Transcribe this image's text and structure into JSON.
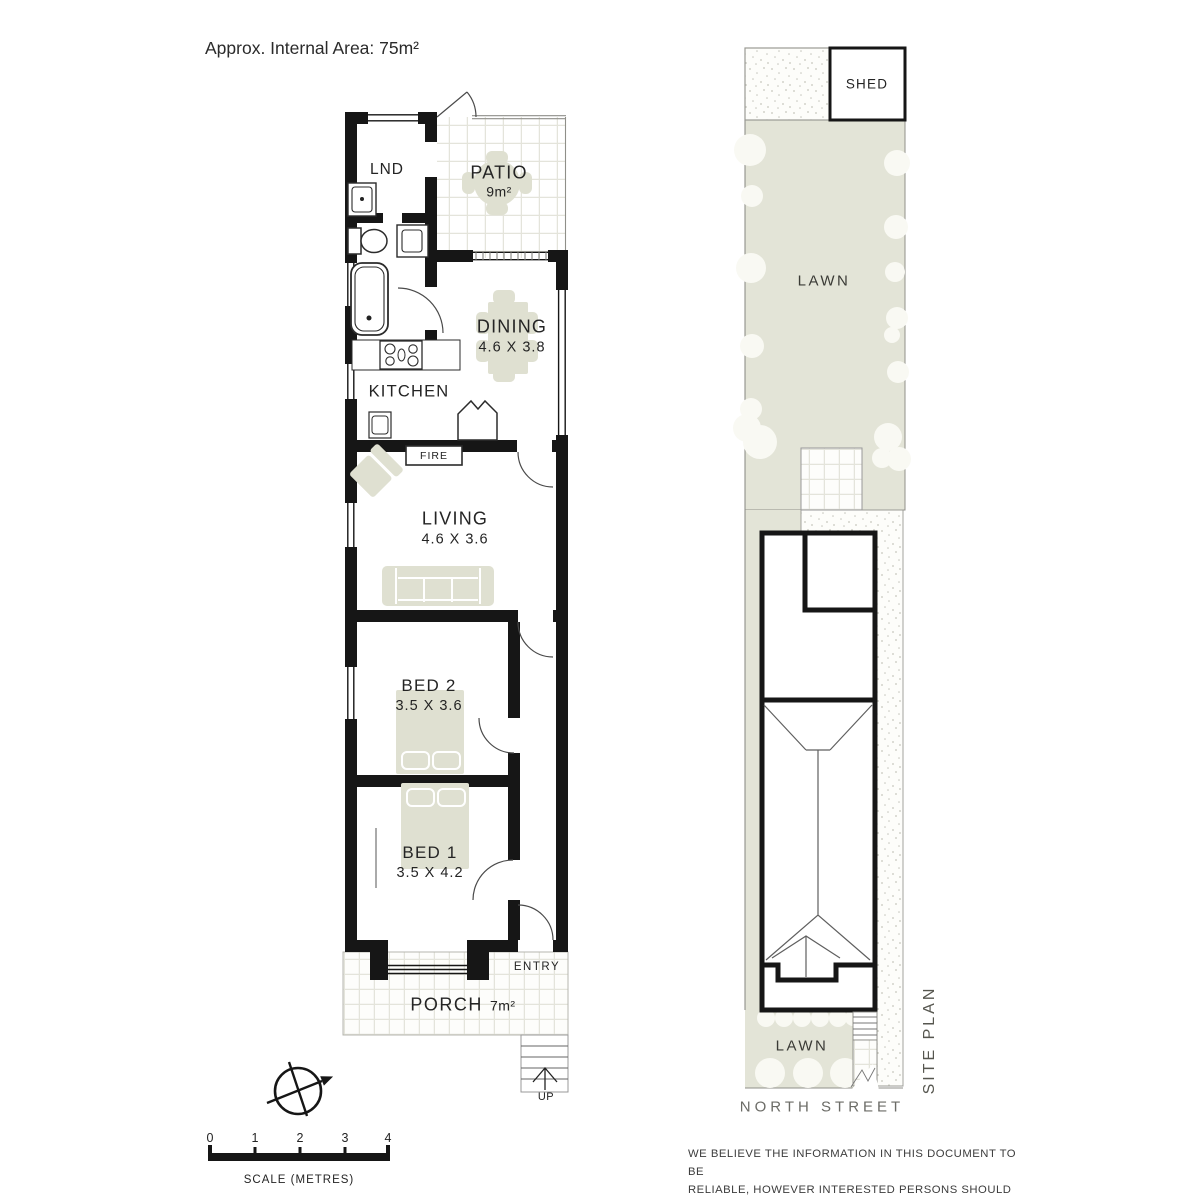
{
  "title": "Approx. Internal Area: 75m²",
  "floor_plan": {
    "lnd": {
      "label": "LND"
    },
    "patio": {
      "label": "PATIO",
      "area": "9m²"
    },
    "dining": {
      "label": "DINING",
      "dims": "4.6 X 3.8"
    },
    "kitchen": {
      "label": "KITCHEN"
    },
    "fireplace": {
      "label": "FIRE"
    },
    "living": {
      "label": "LIVING",
      "dims": "4.6 X 3.6"
    },
    "bed2": {
      "label": "BED 2",
      "dims": "3.5 X 3.6"
    },
    "bed1": {
      "label": "BED 1",
      "dims": "3.5 X 4.2"
    },
    "entry": {
      "label": "ENTRY"
    },
    "porch": {
      "label": "PORCH",
      "area": "7m²"
    },
    "stairs": {
      "label": "UP"
    }
  },
  "site_plan": {
    "shed": {
      "label": "SHED"
    },
    "lawn_back": {
      "label": "LAWN"
    },
    "lawn_front": {
      "label": "LAWN"
    },
    "street": {
      "label": "NORTH STREET"
    },
    "caption": "SITE PLAN"
  },
  "scale_bar": {
    "ticks": [
      "0",
      "1",
      "2",
      "3",
      "4"
    ],
    "label": "SCALE (METRES)"
  },
  "disclaimer": {
    "lines": [
      "WE BELIEVE THE INFORMATION IN THIS DOCUMENT TO BE",
      "RELIABLE, HOWEVER INTERESTED PERSONS SHOULD MAKE",
      "THEIR OWN ENQUIRIES. DIMENSIONS ARE APPROXIMATE."
    ]
  },
  "colors": {
    "wall": "#161616",
    "lawn": "#e3e4d7",
    "furniture": "#dfe0d1",
    "tile_line": "#e4e4db",
    "speckle": "#c6c6bd"
  }
}
